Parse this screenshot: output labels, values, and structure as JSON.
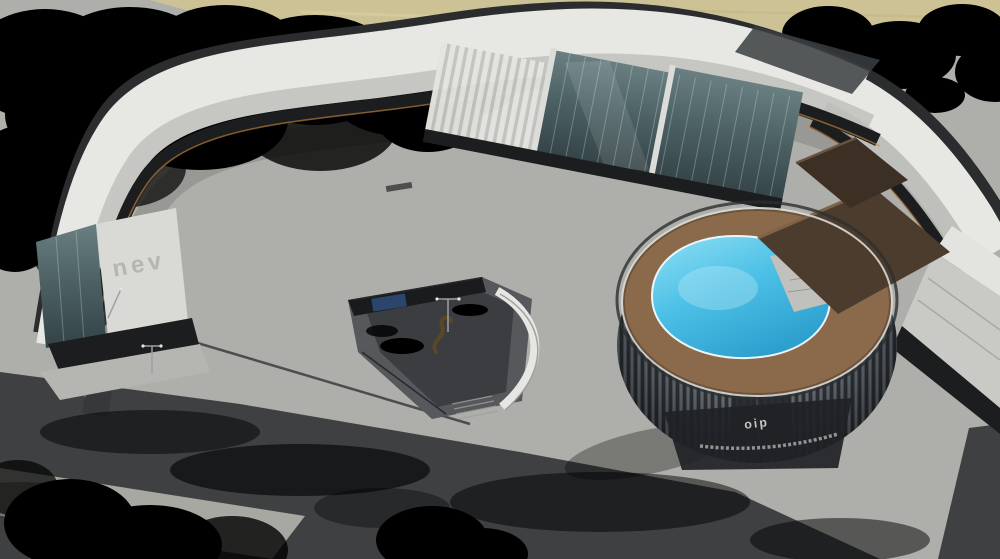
{
  "scene": {
    "alt": "Aerial 3D architectural rendering of a curved mixed-use retail plaza with a cylindrical corner building topped by a turquoise rooftop pool, palm-lined courtyard, kiosk row, outdoor dining terraces and a wide boulevard with cars",
    "signage": {
      "left_building_wall": "nev",
      "round_building_glass": "oip"
    },
    "palette": {
      "field": "#cdc295",
      "tree-dark": "#2c3a28",
      "tree-mid": "#36452f",
      "tree-light": "#4a5c3a",
      "palm-green": "#4c6b38",
      "asphalt": "#3e4042",
      "asphalt-dark": "#313337",
      "lane-line": "#d6d6d1",
      "pavement": "#aeaeaa",
      "pavement-light": "#c6c6c1",
      "parapet": "#2a2c2e",
      "roof-white": "#e7e7e4",
      "facade-white": "#d9d9d5",
      "storefront": "#1c1d1f",
      "warm-light": "#c98a3e",
      "glass-dark": "#334246",
      "deck-wood": "#8a6a4b",
      "pool-light": "#8fdff5",
      "pool-deep": "#2d9fce",
      "roof-brown": "#4c3c2e",
      "kiosk-wood": "#8a6848",
      "canopy-dark": "#232527",
      "umbrella-white": "#eceae3",
      "umbrella-green": "#5d7a4a",
      "median-paver": "#a8a8a3",
      "ramp-white": "#e6e6e3",
      "car-dark": "#2a2c2e",
      "car-white": "#e9e9e7",
      "car-silver": "#b9bcbf",
      "person-dark": "#26262a",
      "person-light": "#e8e7e3",
      "person-red": "#a83a32",
      "person-blue": "#3a4a6b"
    },
    "road": {
      "lane_lines": [
        [
          0,
          402,
          758,
          512,
          "16 20",
          0.85
        ],
        [
          0,
          436,
          610,
          536,
          "16 20",
          0.85
        ],
        [
          20,
          385,
          745,
          494,
          "",
          0.5
        ],
        [
          988,
          430,
          962,
          559,
          "12 14",
          0.85
        ],
        [
          969,
          427,
          941,
          559,
          "",
          0.5
        ]
      ]
    },
    "traffic": {
      "cars": [
        {
          "x": 38,
          "y": 388,
          "rot": -11,
          "color": "car-dark"
        },
        {
          "x": 150,
          "y": 436,
          "rot": -10,
          "color": "car-white"
        },
        {
          "x": 252,
          "y": 489,
          "rot": -9,
          "color": "car-silver"
        },
        {
          "x": 520,
          "y": 490,
          "rot": -8,
          "color": "car-silver"
        },
        {
          "x": 988,
          "y": 482,
          "rot": 75,
          "color": "car-white"
        }
      ]
    },
    "roof": {
      "hvac_units": [
        [
          150,
          97,
          -35
        ],
        [
          185,
          82,
          -30
        ],
        [
          225,
          70,
          -25
        ],
        [
          270,
          60,
          -20
        ],
        [
          320,
          52,
          -15
        ],
        [
          372,
          45,
          -12
        ],
        [
          425,
          38,
          -10
        ],
        [
          478,
          32,
          -6
        ],
        [
          532,
          27,
          -3
        ],
        [
          585,
          25,
          0
        ],
        [
          638,
          27,
          3
        ],
        [
          690,
          33,
          8
        ],
        [
          740,
          44,
          14
        ],
        [
          790,
          58,
          20
        ],
        [
          838,
          76,
          27
        ],
        [
          882,
          99,
          33
        ],
        [
          922,
          128,
          40
        ],
        [
          956,
          162,
          45
        ],
        [
          80,
          240,
          -60
        ],
        [
          66,
          288,
          -70
        ],
        [
          102,
          170,
          -50
        ],
        [
          124,
          133,
          -42
        ],
        [
          205,
          130,
          -28
        ],
        [
          262,
          117,
          -22
        ],
        [
          325,
          105,
          -16
        ],
        [
          390,
          95,
          -12
        ],
        [
          455,
          86,
          -8
        ],
        [
          520,
          80,
          -4
        ],
        [
          580,
          78,
          0
        ],
        [
          640,
          82,
          4
        ],
        [
          698,
          92,
          9
        ],
        [
          752,
          106,
          15
        ],
        [
          805,
          126,
          22
        ],
        [
          855,
          152,
          28
        ],
        [
          900,
          184,
          35
        ],
        [
          938,
          220,
          42
        ],
        [
          148,
          190,
          -45
        ],
        [
          120,
          238,
          -55
        ],
        [
          105,
          285,
          -65
        ]
      ],
      "skylights": [
        [
          95,
          205,
          -48
        ],
        [
          112,
          176,
          -45
        ],
        [
          132,
          150,
          -40
        ],
        [
          156,
          127,
          -35
        ],
        [
          185,
          107,
          -30
        ],
        [
          242,
          88,
          -22
        ],
        [
          300,
          74,
          -18
        ],
        [
          355,
          64,
          -14
        ]
      ],
      "penthouses": [
        [
          198,
          118,
          -14,
          64,
          30
        ],
        [
          548,
          16,
          -2,
          36,
          14
        ],
        [
          764,
          36,
          12,
          42,
          16
        ],
        [
          372,
          56,
          -12,
          30,
          12
        ],
        [
          905,
          42,
          22,
          44,
          20
        ],
        [
          840,
          60,
          18,
          30,
          12
        ]
      ],
      "planters": [
        [
          352,
          62
        ],
        [
          420,
          52
        ],
        [
          548,
          40
        ],
        [
          610,
          30
        ],
        [
          700,
          42
        ],
        [
          764,
          58
        ],
        [
          105,
          212
        ],
        [
          122,
          206
        ],
        [
          138,
          201
        ],
        [
          660,
          36
        ],
        [
          460,
          44
        ],
        [
          508,
          36
        ]
      ]
    },
    "plaza": {
      "paving_stripes": [
        [
          260,
          232,
          560,
          163
        ],
        [
          292,
          262,
          620,
          183
        ],
        [
          324,
          292,
          668,
          204
        ],
        [
          356,
          322,
          700,
          228
        ],
        [
          432,
          322,
          492,
          308
        ],
        [
          440,
          336,
          500,
          322
        ],
        [
          660,
          456,
          614,
          546
        ],
        [
          702,
          470,
          682,
          556
        ],
        [
          748,
          478,
          750,
          559
        ],
        [
          792,
          472,
          824,
          550
        ],
        [
          834,
          458,
          886,
          528
        ],
        [
          868,
          438,
          932,
          498
        ],
        [
          884,
          430,
          1000,
          404
        ],
        [
          868,
          456,
          1000,
          428
        ],
        [
          905,
          540,
          1000,
          486
        ],
        [
          872,
          552,
          990,
          496
        ]
      ],
      "kiosks": [
        [
          196,
          349,
          -13,
          0.95
        ],
        [
          238,
          361,
          -13,
          1.0
        ],
        [
          280,
          374,
          -13,
          1.02
        ],
        [
          322,
          387,
          -13,
          1.05
        ],
        [
          364,
          399,
          -13,
          1.08
        ],
        [
          406,
          412,
          -13,
          1.12
        ]
      ],
      "benches": [
        [
          300,
          352,
          -13
        ],
        [
          342,
          364,
          -13
        ],
        [
          386,
          377,
          -13
        ],
        [
          428,
          390,
          -13
        ],
        [
          468,
          402,
          -13
        ],
        [
          252,
          340,
          -13
        ],
        [
          404,
          362,
          -12
        ],
        [
          422,
          372,
          -12
        ]
      ],
      "pergolas": [
        [
          82,
          333,
          30,
          -18
        ],
        [
          120,
          344,
          30,
          -18
        ],
        [
          322,
          256,
          26,
          -10
        ],
        [
          393,
          222,
          28,
          -10
        ],
        [
          464,
          219,
          28,
          -10
        ],
        [
          529,
          214,
          26,
          -10
        ],
        [
          728,
          464,
          34,
          -14
        ],
        [
          801,
          461,
          34,
          -14
        ],
        [
          853,
          451,
          32,
          -14
        ]
      ],
      "umbrellas": [
        [
          95,
          351,
          "w"
        ],
        [
          108,
          356,
          "w"
        ],
        [
          121,
          361,
          "w"
        ],
        [
          134,
          366,
          "w"
        ],
        [
          85,
          345,
          "w"
        ],
        [
          744,
          437,
          "w"
        ],
        [
          759,
          447,
          "w"
        ],
        [
          772,
          453,
          "w"
        ],
        [
          783,
          443,
          "w"
        ],
        [
          749,
          457,
          "g"
        ],
        [
          736,
          449,
          "g"
        ],
        [
          776,
          461,
          "g"
        ],
        [
          940,
          452,
          "w"
        ],
        [
          926,
          446,
          "w"
        ]
      ]
    },
    "pool": {
      "loungers": [
        [
          664,
          254,
          -35
        ],
        [
          652,
          274,
          -15
        ],
        [
          646,
          295,
          0
        ],
        [
          650,
          316,
          15
        ],
        [
          662,
          335,
          30
        ],
        [
          680,
          350,
          45
        ],
        [
          702,
          361,
          60
        ],
        [
          728,
          368,
          75
        ],
        [
          690,
          242,
          -55
        ],
        [
          714,
          236,
          -70
        ],
        [
          740,
          233,
          -85
        ],
        [
          772,
          214,
          -25
        ],
        [
          788,
          202,
          -25
        ]
      ],
      "umbrellas": [
        [
          652,
          268
        ],
        [
          643,
          300
        ],
        [
          655,
          331
        ],
        [
          680,
          355
        ],
        [
          712,
          368
        ]
      ],
      "cabanas": [
        [
          848,
          158
        ],
        [
          825,
          172
        ],
        [
          801,
          186
        ],
        [
          778,
          200
        ],
        [
          758,
          214
        ]
      ]
    },
    "landscape": {
      "palms": [
        [
          312,
          182,
          1
        ],
        [
          445,
          192,
          1
        ],
        [
          512,
          186,
          1
        ],
        [
          574,
          200,
          1
        ],
        [
          627,
          147,
          1
        ],
        [
          688,
          128,
          1
        ],
        [
          527,
          307,
          1.35
        ],
        [
          352,
          247,
          1
        ],
        [
          302,
          267,
          1
        ],
        [
          612,
          214,
          1
        ],
        [
          585,
          244,
          1
        ],
        [
          652,
          190,
          1
        ],
        [
          700,
          180,
          0.9
        ],
        [
          420,
          240,
          0.9
        ]
      ],
      "round_trees": [
        [
          493,
          450,
          12
        ],
        [
          923,
          485,
          13
        ],
        [
          827,
          517,
          12
        ],
        [
          545,
          408,
          10
        ],
        [
          905,
          330,
          10
        ],
        [
          928,
          302,
          9
        ],
        [
          888,
          356,
          9
        ],
        [
          463,
          437,
          8
        ]
      ]
    },
    "people": [
      [
        395,
        249,
        "l"
      ],
      [
        404,
        253,
        "d"
      ],
      [
        540,
        242,
        "d"
      ],
      [
        560,
        234,
        "l"
      ],
      [
        610,
        226,
        "d"
      ],
      [
        656,
        212,
        "l"
      ],
      [
        672,
        216,
        "d"
      ],
      [
        690,
        206,
        "l"
      ],
      [
        702,
        213,
        "d"
      ],
      [
        745,
        199,
        "l"
      ],
      [
        640,
        321,
        "d"
      ],
      [
        612,
        341,
        "l"
      ],
      [
        582,
        361,
        "d"
      ],
      [
        500,
        396,
        "l"
      ],
      [
        472,
        409,
        "d"
      ],
      [
        452,
        301,
        "d"
      ],
      [
        432,
        311,
        "l"
      ],
      [
        419,
        306,
        "r"
      ],
      [
        210,
        339,
        "d"
      ],
      [
        219,
        343,
        "l"
      ],
      [
        256,
        353,
        "r"
      ],
      [
        472,
        431,
        "d"
      ],
      [
        632,
        471,
        "l"
      ],
      [
        660,
        479,
        "d"
      ],
      [
        700,
        473,
        "l"
      ],
      [
        120,
        329,
        "d"
      ],
      [
        102,
        323,
        "l"
      ],
      [
        930,
        471,
        "d"
      ],
      [
        948,
        479,
        "l"
      ],
      [
        956,
        463,
        "d"
      ],
      [
        700,
        251,
        "l"
      ],
      [
        678,
        263,
        "d"
      ],
      [
        726,
        241,
        "l"
      ],
      [
        595,
        320,
        "b"
      ],
      [
        625,
        470,
        "r"
      ]
    ]
  }
}
